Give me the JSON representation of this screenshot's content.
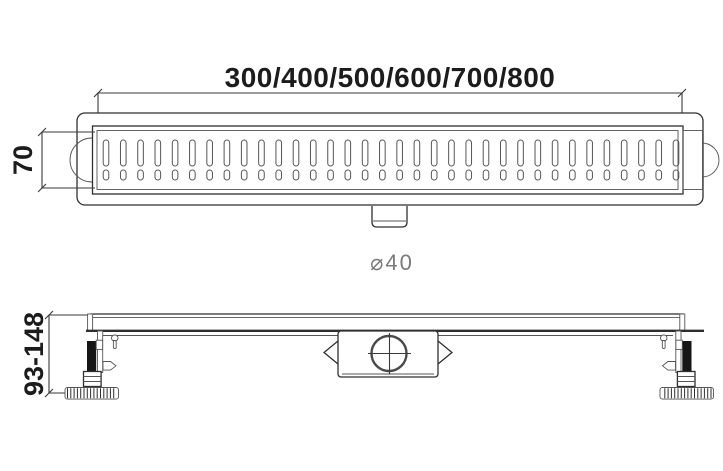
{
  "drawing": {
    "type": "linear-shower-drain-technical-drawing",
    "length_options_label": "300/400/500/600/700/800",
    "grate_width_label": "70",
    "outlet_diameter_label": "⌀40",
    "install_height_label": "93-148"
  },
  "colors": {
    "line": "#2f2f2f",
    "line_light": "#555555",
    "dimension_text": "#1c1c1c",
    "diameter_text": "#7b7b7b",
    "rod_fill": "#161616",
    "background": "#ffffff"
  }
}
